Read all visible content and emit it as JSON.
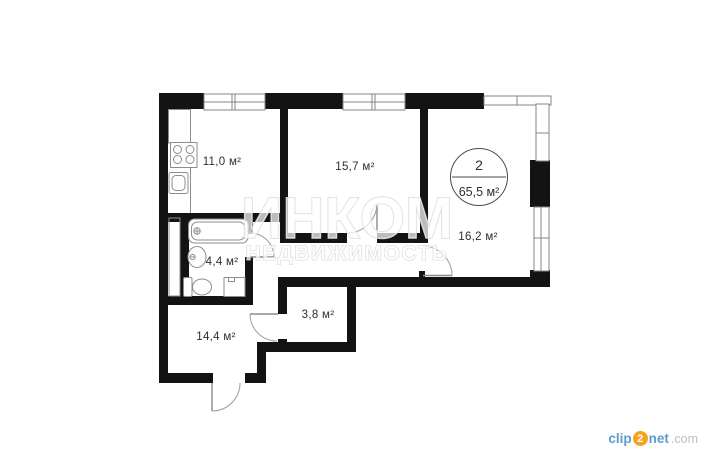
{
  "page": {
    "background": "#ffffff"
  },
  "floorplan": {
    "type": "apartment-floor-plan",
    "badge": {
      "room_count": "2",
      "total_area": "65,5 м²"
    },
    "rooms": [
      {
        "name": "kitchen",
        "area": "11,0 м²"
      },
      {
        "name": "living-room",
        "area": "15,7 м²"
      },
      {
        "name": "bedroom",
        "area": "16,2 м²"
      },
      {
        "name": "bathroom",
        "area": "4,4 м²"
      },
      {
        "name": "storage",
        "area": "3,8 м²"
      },
      {
        "name": "hallway",
        "area": "14,4 м²"
      }
    ],
    "fixtures": [
      "stove",
      "kitchen-sink",
      "ventilation-shaft",
      "bathtub",
      "wash-basin",
      "toilet",
      "washing-machine"
    ],
    "colors": {
      "wall": "#131313",
      "window_line": "#868686",
      "door_line": "#a3a3a3",
      "fixture_line": "#8d8d8d",
      "label_text": "#2e2e2e"
    }
  },
  "watermark": {
    "title": "ИНКОМ",
    "subtitle": "НЕДВИЖИМОСТЬ"
  },
  "branding": {
    "clip": "clip",
    "two": "2",
    "net": "net",
    "com": ".com",
    "accent_blue": "#5b9ecb",
    "accent_orange": "#f6a21c"
  }
}
